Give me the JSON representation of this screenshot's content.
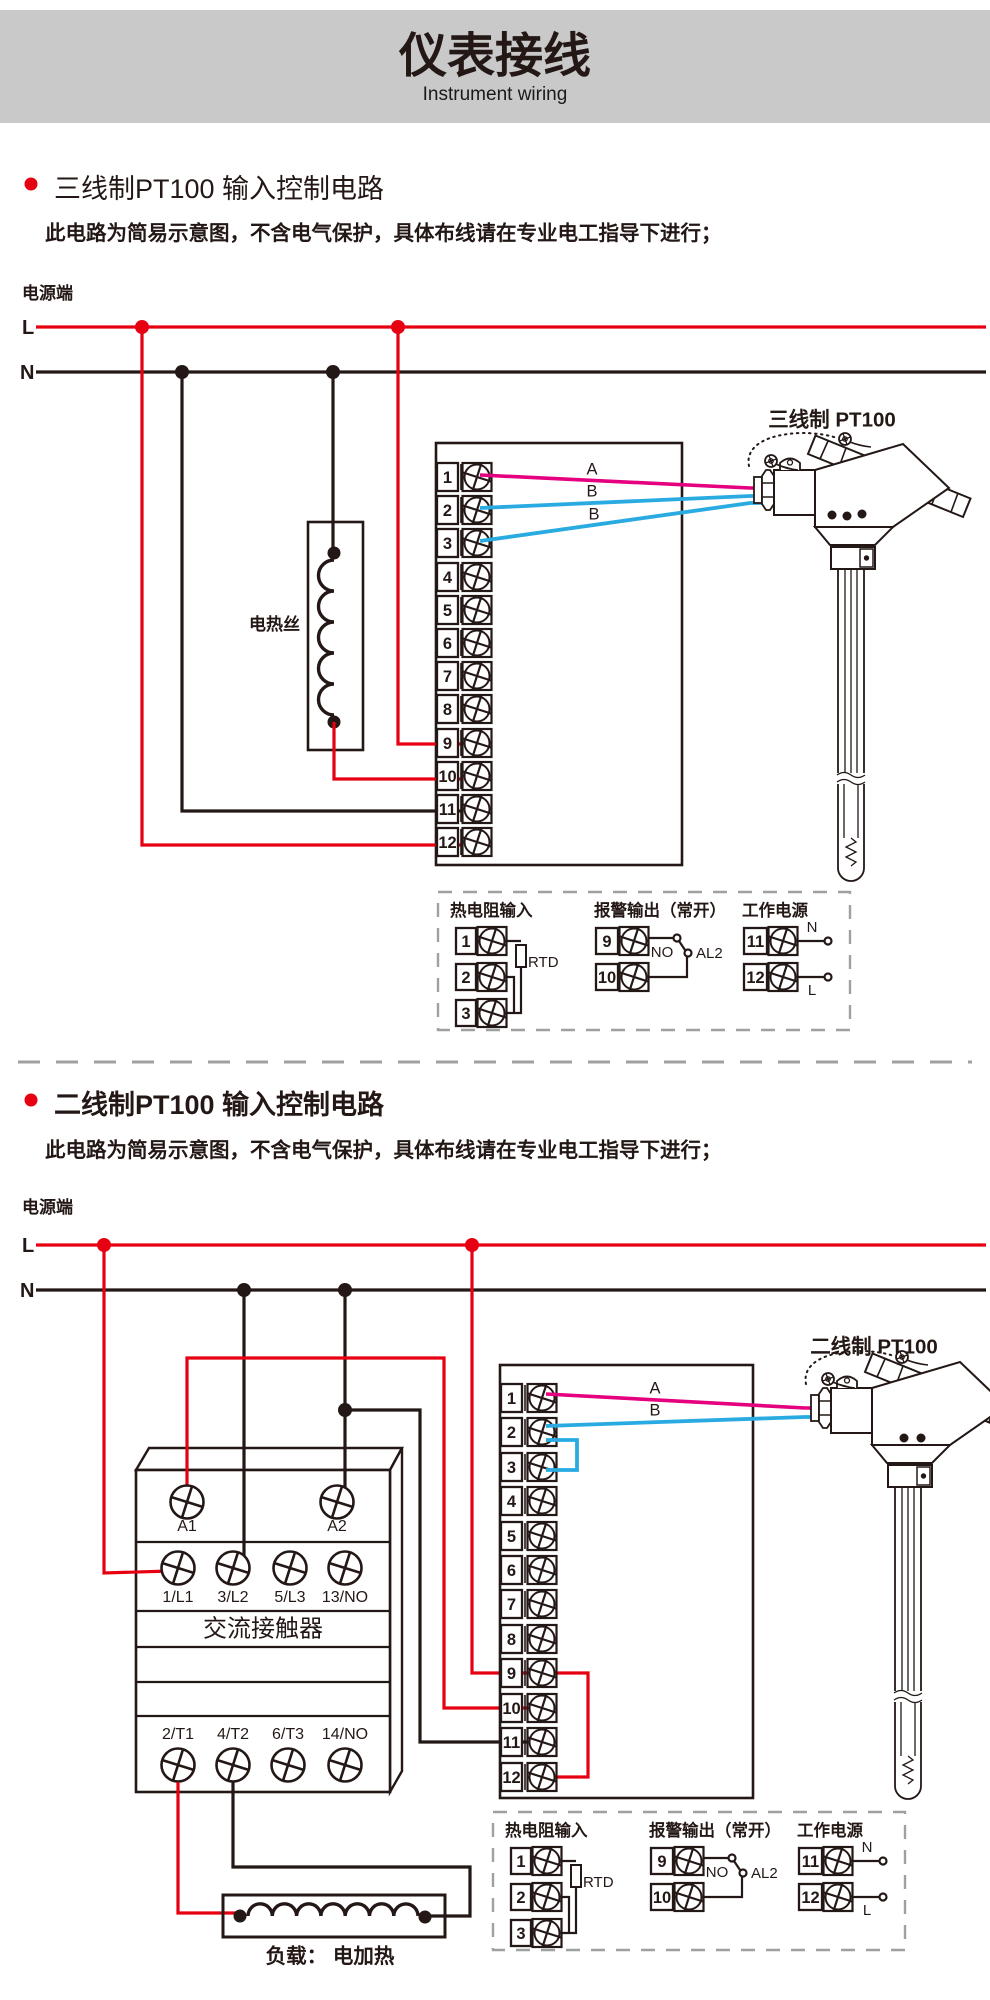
{
  "header": {
    "title": "仪表接线",
    "subtitle": "Instrument wiring"
  },
  "colors": {
    "accent_red": "#e60012",
    "wire_magenta": "#e4007f",
    "wire_blue": "#29abe2",
    "ink": "#231815",
    "band_gray": "#c9c9c9"
  },
  "sections": [
    {
      "heading": "三线制PT100 输入控制电路",
      "note": "此电路为简易示意图，不含电气保护，具体布线请在专业电工指导下进行；",
      "power_label": "电源端",
      "live": "L",
      "neutral": "N",
      "heater_label": "电热丝",
      "sensor_label": "三线制  PT100",
      "wire_labels": {
        "a": "A",
        "b1": "B",
        "b2": "B"
      },
      "terminals": [
        "1",
        "2",
        "3",
        "4",
        "5",
        "6",
        "7",
        "8",
        "9",
        "10",
        "11",
        "12"
      ]
    },
    {
      "heading": "二线制PT100 输入控制电路",
      "note": "此电路为简易示意图，不含电气保护，具体布线请在专业电工指导下进行；",
      "power_label": "电源端",
      "live": "L",
      "neutral": "N",
      "sensor_label": "二线制  PT100",
      "wire_labels": {
        "a": "A",
        "b": "B"
      },
      "terminals": [
        "1",
        "2",
        "3",
        "4",
        "5",
        "6",
        "7",
        "8",
        "9",
        "10",
        "11",
        "12"
      ],
      "contactor": {
        "label": "交流接触器",
        "coil_terminals": [
          "A1",
          "A2"
        ],
        "line_terminals": [
          "1/L1",
          "3/L2",
          "5/L3",
          "13/NO"
        ],
        "load_terminals": [
          "2/T1",
          "4/T2",
          "6/T3",
          "14/NO"
        ]
      },
      "load_label": "负载：  电加热"
    }
  ],
  "legend": {
    "rtd_title": "热电阻输入",
    "rtd_label": "RTD",
    "alarm_title": "报警输出（常开）",
    "alarm_no": "NO",
    "alarm_relay": "AL2",
    "power_title": "工作电源",
    "neutral": "N",
    "live": "L",
    "terminals": [
      "1",
      "2",
      "3",
      "9",
      "10",
      "11",
      "12"
    ]
  }
}
